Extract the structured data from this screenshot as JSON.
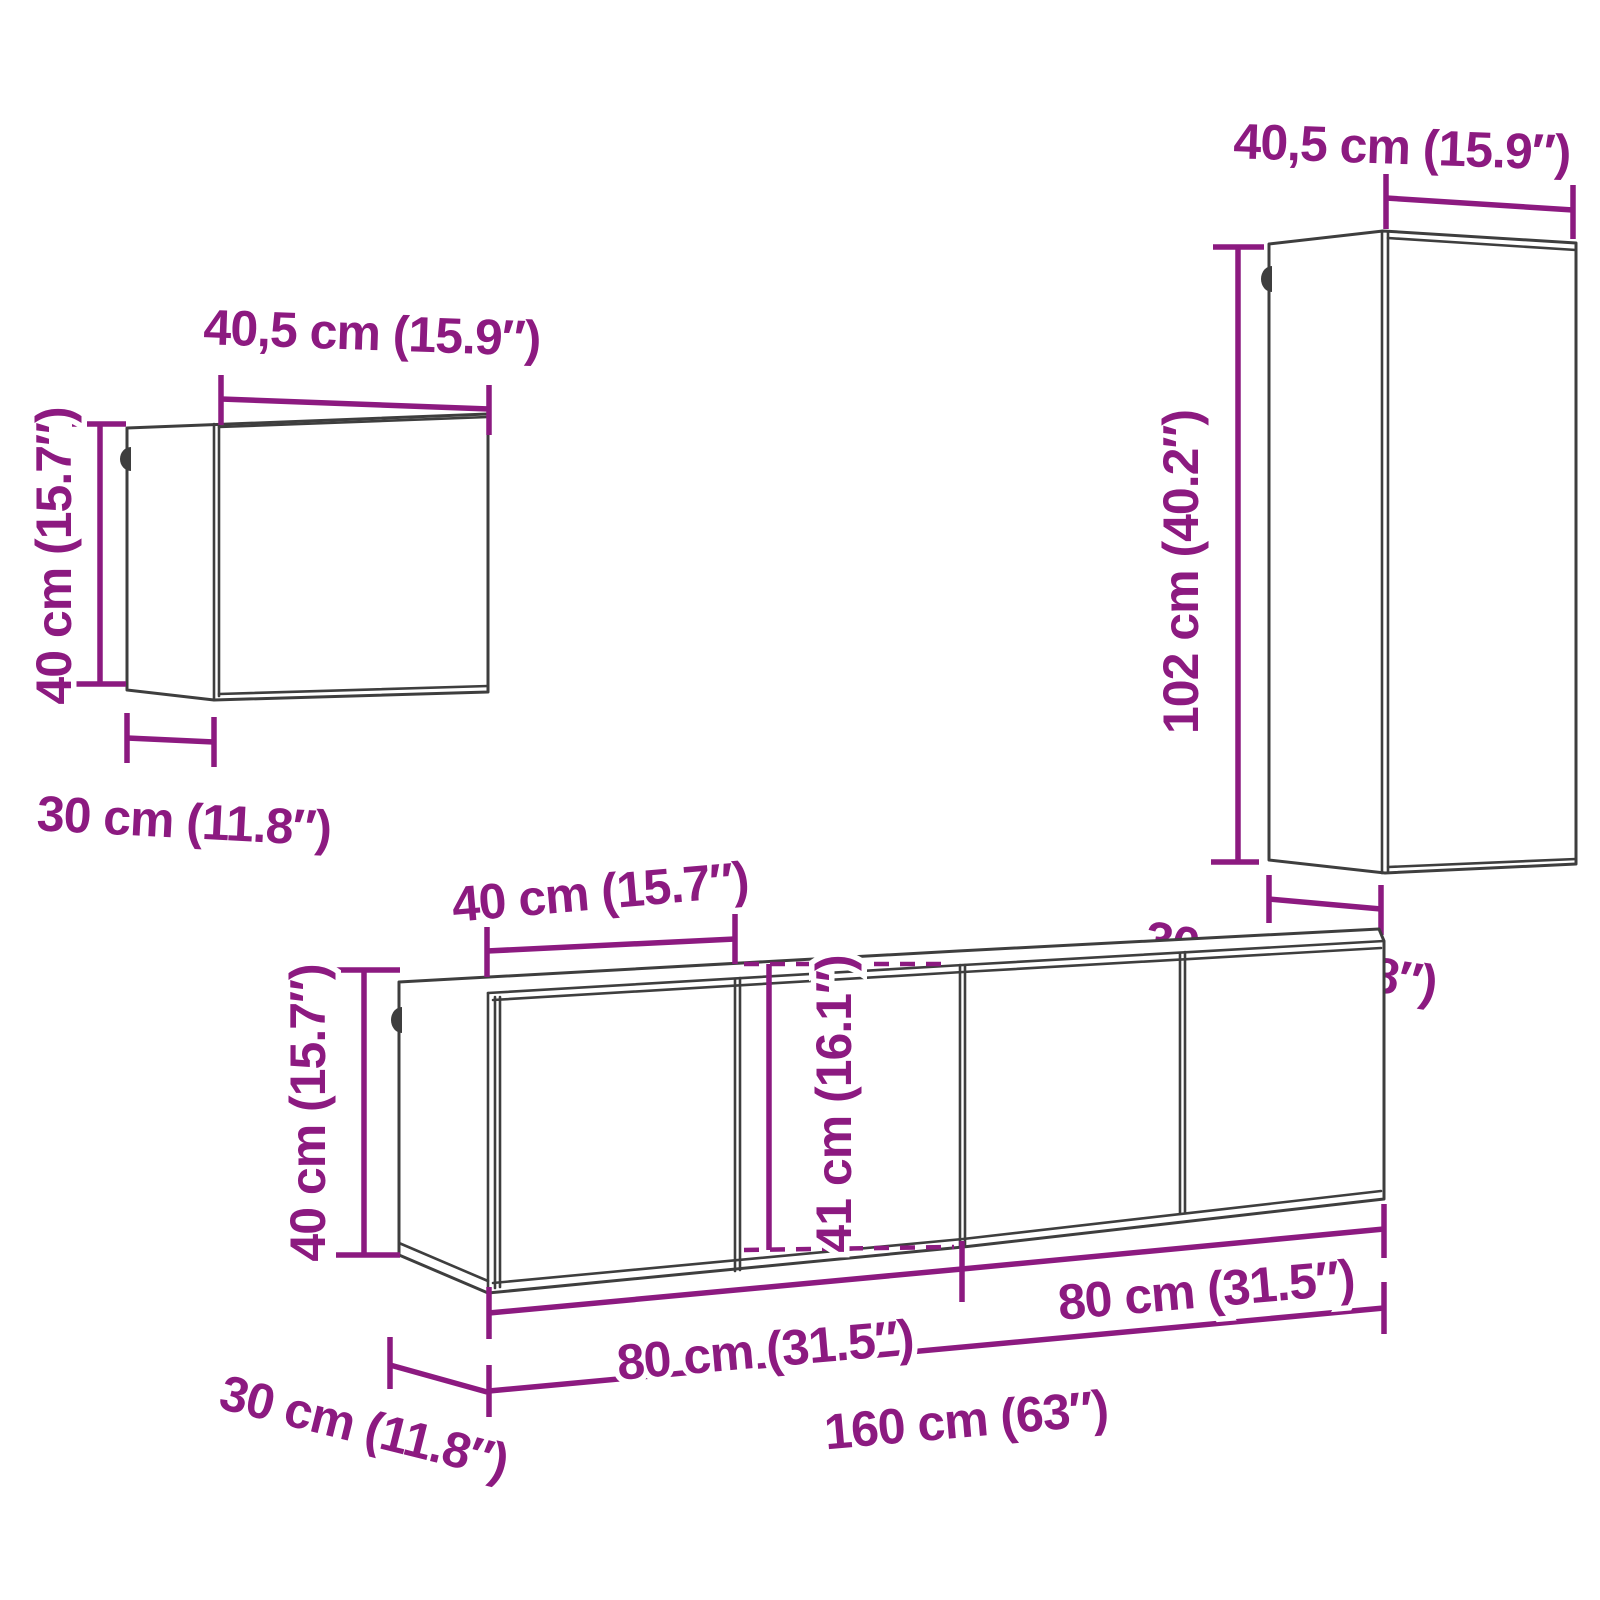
{
  "colors": {
    "dimension": "#8c1a80",
    "outline": "#3e3e3e",
    "background": "#ffffff"
  },
  "diagram": {
    "type": "furniture-dimension-diagram",
    "pieces": "4-piece wall-mounted TV cabinet set",
    "cube_cabinet": {
      "width": "40,5 cm (15.9″)",
      "height": "40 cm (15.7″)",
      "depth": "30 cm (11.8″)"
    },
    "tall_cabinet": {
      "width": "40,5 cm (15.9″)",
      "height": "102 cm (40.2″)",
      "depth": "30 cm (11.8″)"
    },
    "tv_unit": {
      "door_width": "40 cm (15.7″)",
      "height_left": "40 cm (15.7″)",
      "height_middle": "41 cm (16.1″)",
      "width_left_module": "80 cm (31.5″)",
      "width_right_module": "80 cm (31.5″)",
      "width_total": "160 cm (63″)",
      "depth": "30 cm (11.8″)"
    }
  }
}
